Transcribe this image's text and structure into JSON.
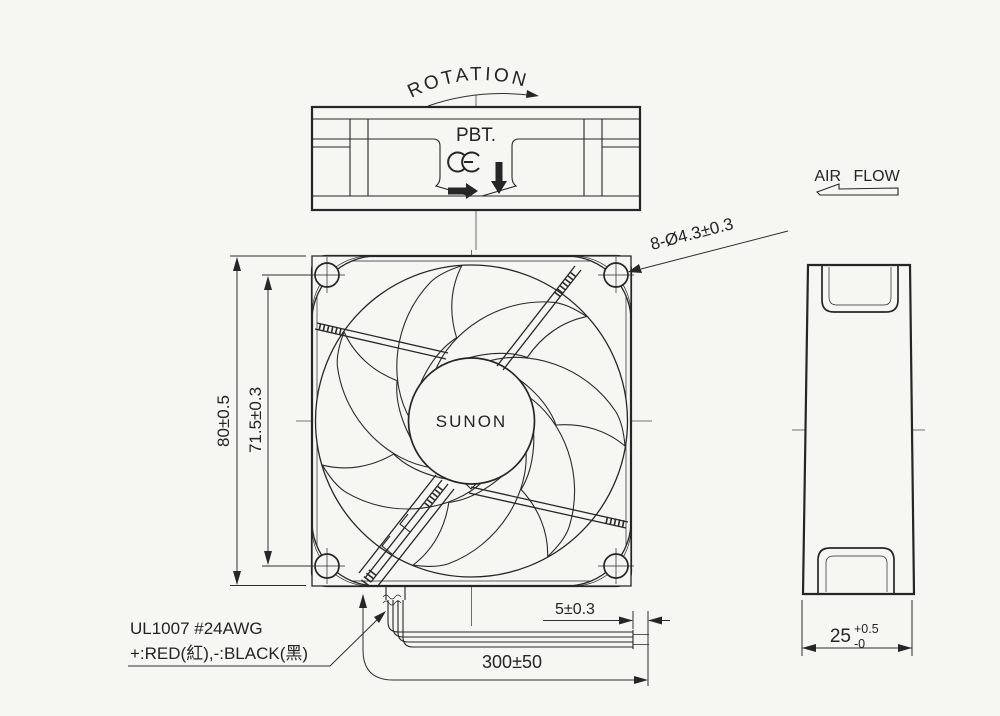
{
  "labels": {
    "rotation": "ROTATION",
    "material": "PBT.",
    "ce_mark": "CE",
    "brand": "SUNON",
    "air_flow": "AIR FLOW"
  },
  "dimensions": {
    "frame_size": "80±0.5",
    "hole_pitch": "71.5±0.3",
    "mounting_holes": "8-Ø4.3±0.3",
    "strip_length": "5±0.3",
    "lead_length": "300±50",
    "depth": "25",
    "depth_tol_plus": "+0.5",
    "depth_tol_minus": "-0"
  },
  "lead_wire": {
    "spec": "UL1007 #24AWG",
    "polarity": "+:RED(紅),-:BLACK(黑)"
  }
}
